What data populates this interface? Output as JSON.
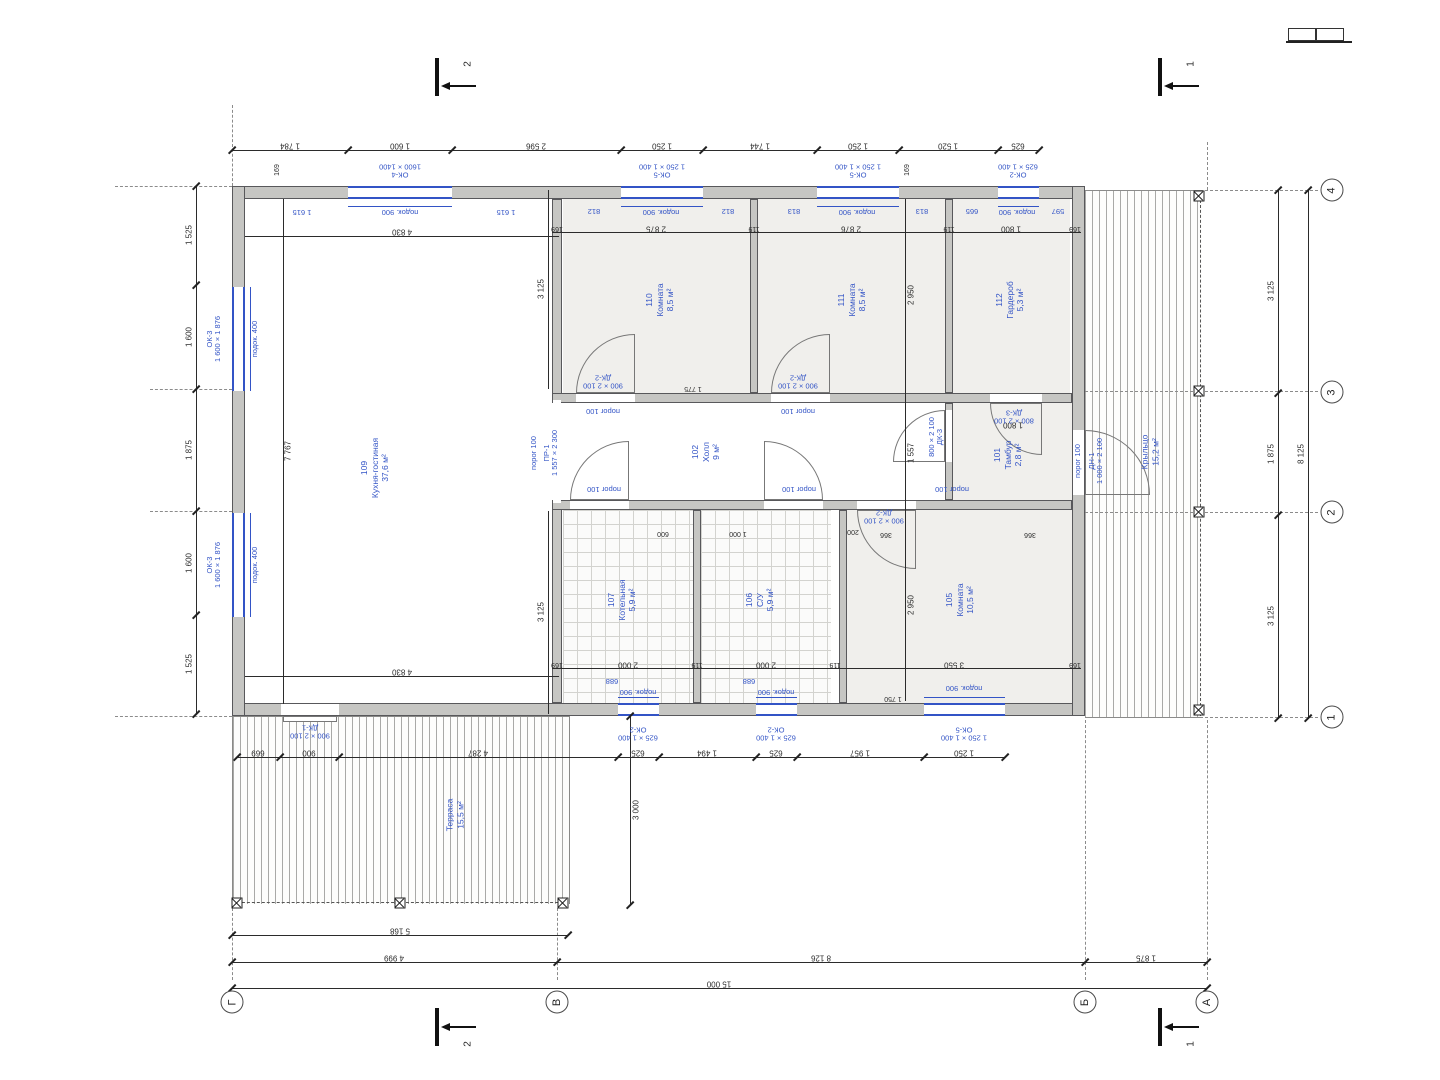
{
  "accent_blue": "#3354c6",
  "wall_gray": "#c6c6c3",
  "rooms": {
    "r109": {
      "num": "109",
      "name": "Кухня-гостиная",
      "area": "37,6 м²"
    },
    "r110": {
      "num": "110",
      "name": "Комната",
      "area": "8,5 м²"
    },
    "r111": {
      "num": "111",
      "name": "Комната",
      "area": "8,5 м²"
    },
    "r112": {
      "num": "112",
      "name": "Гардероб",
      "area": "5,3 м²"
    },
    "r102": {
      "num": "102",
      "name": "Холл",
      "area": "9 м²"
    },
    "r101": {
      "num": "101",
      "name": "Тамбур",
      "area": "2,8 м²"
    },
    "r107": {
      "num": "107",
      "name": "Котельная",
      "area": "5,9 м²"
    },
    "r106": {
      "num": "106",
      "name": "С/У",
      "area": "5,9 м²"
    },
    "r105": {
      "num": "105",
      "name": "Комната",
      "area": "10,5 м²"
    },
    "terrace": {
      "num": "",
      "name": "Терраса",
      "area": "15,5 м²"
    },
    "porch": {
      "num": "",
      "name": "Крыльцо",
      "area": "15,2 м²"
    }
  },
  "grid": {
    "bottom": [
      "Г",
      "В",
      "Б",
      "А"
    ],
    "right": [
      "4",
      "3",
      "2",
      "1"
    ]
  },
  "sections": {
    "s1": "1",
    "s2": "2"
  },
  "dims": {
    "top": [
      "1 784",
      "1 600",
      "2 596",
      "1 250",
      "1 744",
      "1 250",
      "1 520",
      "625"
    ],
    "left": [
      "1 525",
      "1 600",
      "1 875",
      "1 600",
      "1 525"
    ],
    "right": [
      "3 125",
      "1 875",
      "3 125"
    ],
    "right_total": "8 125",
    "mid": [
      "669",
      "900",
      "4 287",
      "625",
      "1 494",
      "625",
      "1 957",
      "1 250"
    ],
    "terrace_width": "5 168",
    "bottom": [
      "4 999",
      "8 126",
      "1 875"
    ],
    "total": "15 000",
    "terrace_depth": "3 000",
    "inner_top": [
      "169",
      "2 875",
      "119",
      "2 876",
      "119",
      "1 800",
      "169"
    ],
    "inner_bottom": [
      "169",
      "2 000",
      "119",
      "2 000",
      "119",
      "3 550",
      "169"
    ],
    "kitchen_w": "4 830",
    "kitchen_h": "7 767",
    "v3125": "3 125",
    "v2950": "2 950",
    "v1557": "1 557",
    "n169": "169",
    "d1775": "1 775",
    "d1800": "1 800",
    "d1750": "1 750",
    "k1615": "1 615",
    "p812": "812",
    "p813": "813",
    "p665": "665",
    "p597": "597",
    "b688": "688",
    "n600": "600",
    "n1000": "1 000",
    "n200": "200",
    "n366": "366"
  },
  "openings": {
    "ok4": {
      "tag": "ОК-4",
      "size": "1600 × 1400"
    },
    "ok5": {
      "tag": "ОК-5",
      "size": "1 250 × 1 400"
    },
    "ok2": {
      "tag": "ОК-2",
      "size": "625 × 1 400"
    },
    "ok3": {
      "tag": "ОК-3",
      "size": "1 600 × 1 876"
    },
    "dk1": {
      "tag": "ДК-1",
      "size": "900 × 2 100"
    },
    "dk2": {
      "tag": "ДК-2",
      "size": "900 × 2 100"
    },
    "dk3": {
      "tag": "ДК-3",
      "size": "800 × 2 100"
    },
    "dn1": {
      "tag": "ДН-1",
      "size": "1 000 × 2 100"
    },
    "pr1": {
      "tag": "ПР-1",
      "size": "1 557 × 2 300"
    },
    "sill900": "подок. 900",
    "sill400": "подок. 400",
    "threshold": "порог 100"
  }
}
